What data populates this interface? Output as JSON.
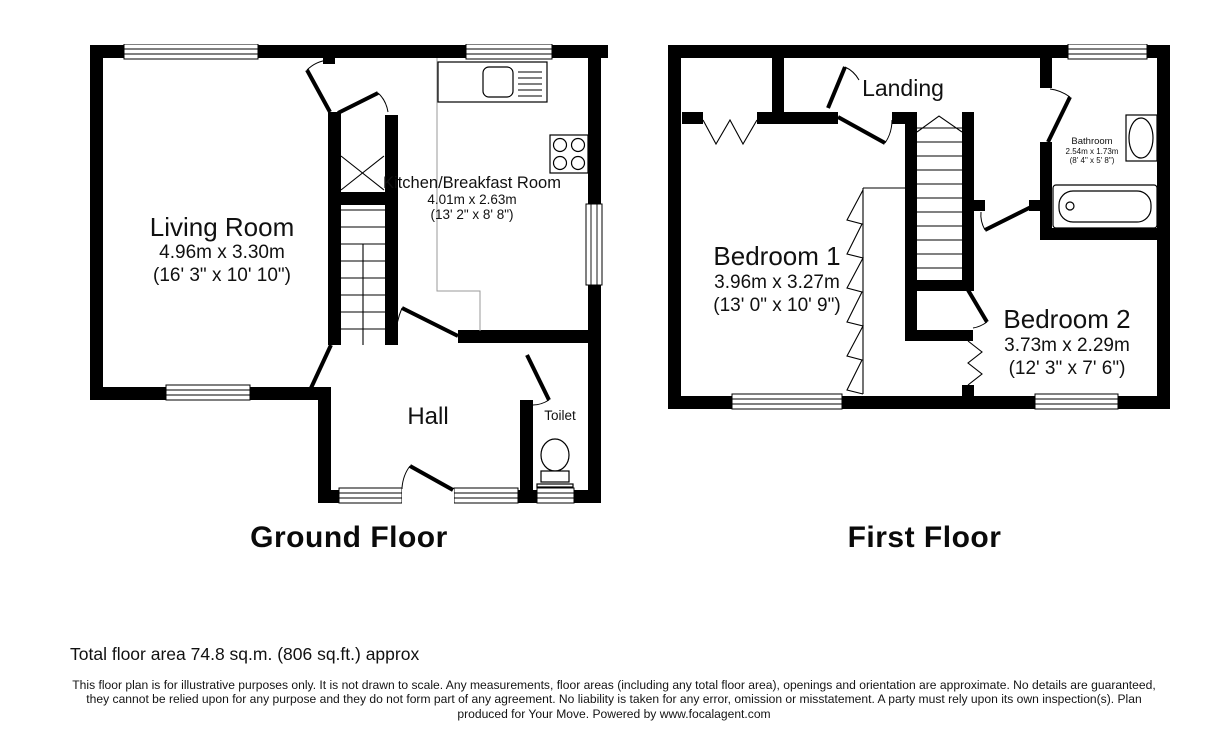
{
  "colors": {
    "wall": "#000000",
    "text": "#111111",
    "area_outline": "#9a9a9a"
  },
  "ground_floor": {
    "title": "Ground Floor",
    "rooms": {
      "living_room": {
        "name": "Living Room",
        "dims_m": "4.96m x 3.30m",
        "dims_ft": "(16' 3\" x 10' 10\")"
      },
      "kitchen": {
        "name": "Kitchen/Breakfast Room",
        "dims_m": "4.01m x 2.63m",
        "dims_ft": "(13' 2\" x 8' 8\")"
      },
      "hall": {
        "name": "Hall"
      },
      "toilet": {
        "name": "Toilet"
      }
    }
  },
  "first_floor": {
    "title": "First Floor",
    "rooms": {
      "landing": {
        "name": "Landing"
      },
      "bedroom1": {
        "name": "Bedroom 1",
        "dims_m": "3.96m x 3.27m",
        "dims_ft": "(13' 0\" x 10' 9\")"
      },
      "bedroom2": {
        "name": "Bedroom 2",
        "dims_m": "3.73m x 2.29m",
        "dims_ft": "(12' 3\" x 7' 6\")"
      },
      "bathroom": {
        "name": "Bathroom",
        "dims_m": "2.54m x 1.73m",
        "dims_ft": "(8' 4\" x 5' 8\")"
      }
    }
  },
  "footer": {
    "total_area": "Total floor area 74.8 sq.m. (806 sq.ft.) approx",
    "disclaimer_line1": "This floor plan is for illustrative purposes only. It is not drawn to scale. Any measurements, floor areas (including any total floor area), openings and orientation are approximate. No details are guaranteed,",
    "disclaimer_line2": "they cannot be relied upon for any purpose and they do not form part of any agreement. No liability is taken for any error, omission or misstatement. A party must rely upon its own inspection(s).  Plan",
    "disclaimer_line3": "produced for Your Move. Powered by www.focalagent.com"
  }
}
